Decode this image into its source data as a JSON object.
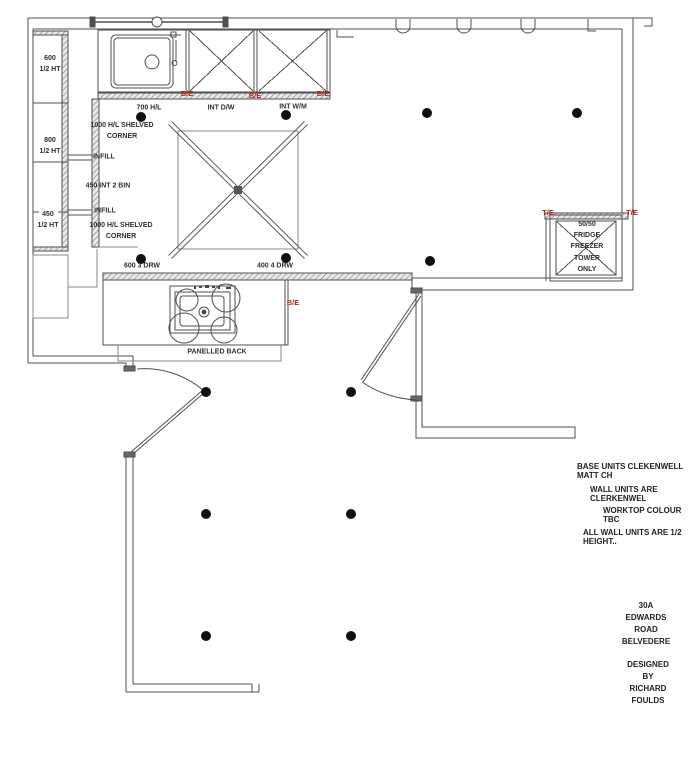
{
  "drawing": {
    "labels": {
      "wall_600": "600\n1/2 HT",
      "wall_800": "800\n1/2 HT",
      "wall_450": "450\n1/2 HT",
      "hl_700": "700 H/L",
      "corner_top": "1000 H/L SHELVED\nCORNER",
      "infill_top": "INFILL",
      "bin_450": "450 INT 2 BIN",
      "infill_bottom": "INFILL",
      "corner_bottom": "1000 H/L SHELVED\nCORNER",
      "drw_600": "600 3 DRW",
      "drw_400": "400 4 DRW",
      "int_dw": "INT D/W",
      "int_wm": "INT W/M",
      "panelled_back": "PANELLED BACK",
      "fridge": "50/50\nFRIDGE\nFREEZER\nTOWER\nONLY"
    },
    "markers": {
      "be": "B/E",
      "te": "T/E"
    },
    "notes": [
      "BASE UNITS CLEKENWELL MATT CH",
      "WALL UNITS ARE CLERKENWEL",
      "WORKTOP COLOUR TBC",
      "ALL WALL UNITS ARE 1/2 HEIGHT.."
    ],
    "address": "30A EDWARDS ROAD\nBELVEDERE",
    "designer": "DESIGNED BY\nRICHARD FOULDS",
    "colors": {
      "line": "#4f4f4f",
      "thin": "#8a8a8a",
      "marker_red": "#b3241c",
      "text": "#2e2e2e"
    },
    "lights": [
      [
        141,
        117
      ],
      [
        286,
        115
      ],
      [
        427,
        113
      ],
      [
        577,
        113
      ],
      [
        141,
        259
      ],
      [
        286,
        258
      ],
      [
        430,
        261
      ],
      [
        206,
        392
      ],
      [
        351,
        392
      ],
      [
        206,
        514
      ],
      [
        351,
        514
      ],
      [
        206,
        636
      ],
      [
        351,
        636
      ]
    ]
  }
}
